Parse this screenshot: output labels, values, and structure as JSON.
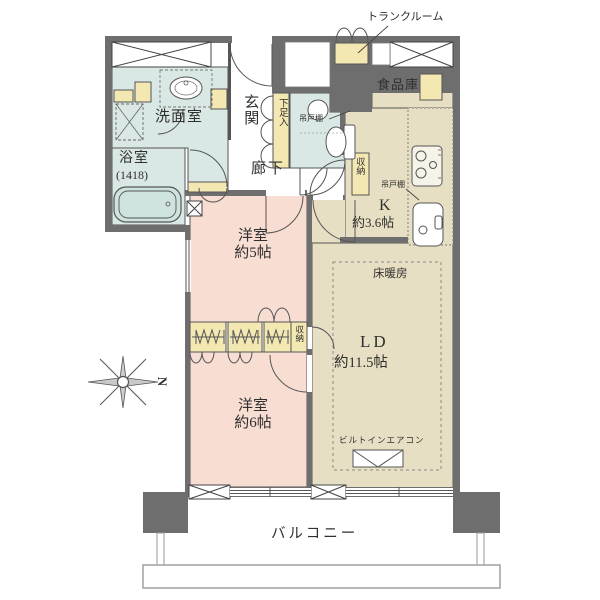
{
  "floorplan": {
    "colors": {
      "wall": "#6e6e6e",
      "room_blue": "#d9e8e4",
      "room_pink": "#f8ddd3",
      "room_beige": "#e7dfc3",
      "storage_yellow": "#f3e7b2",
      "line": "#555555",
      "text": "#2f2f2f"
    },
    "rooms": {
      "trunk_room": {
        "label": "トランクルーム"
      },
      "pantry": {
        "label": "食品庫"
      },
      "washroom": {
        "label": "洗面室"
      },
      "bathroom": {
        "label": "浴室",
        "size": "(1418)"
      },
      "entrance": {
        "label": "玄関"
      },
      "hallway": {
        "label": "廊下"
      },
      "shoe_cabinet": {
        "label": "下足入"
      },
      "toilet_cupboard": {
        "label": "吊戸棚"
      },
      "kitchen_cupboard": {
        "label": "吊戸棚"
      },
      "kitchen_storage": {
        "label": "収納"
      },
      "kitchen": {
        "label": "K",
        "size": "約3.6帖"
      },
      "bedroom_5": {
        "label": "洋室",
        "size": "約5帖"
      },
      "living_dining": {
        "label": "LD",
        "size": "約11.5帖",
        "floor_heating": "床暖房",
        "builtin_ac": "ビルトインエアコン"
      },
      "closet": {
        "label": "収納"
      },
      "bedroom_6": {
        "label": "洋室",
        "size": "約6帖"
      },
      "balcony": {
        "label": "バルコニー"
      }
    },
    "compass": {
      "north": "N"
    }
  }
}
